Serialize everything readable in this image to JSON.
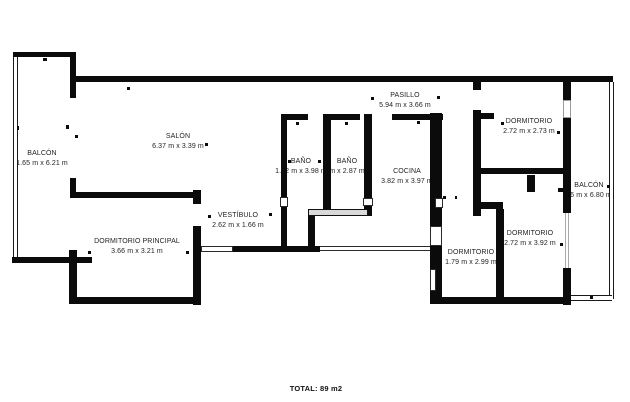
{
  "rooms": [
    {
      "name": "BALCÓN",
      "dims": "1.65 m x 6.21 m"
    },
    {
      "name": "SALÓN",
      "dims": "6.37 m x 3.39 m"
    },
    {
      "name": "PASILLO",
      "dims": "5.94 m x 3.66 m"
    },
    {
      "name": "BAÑO",
      "dims": "1.82 m x 3.98 m"
    },
    {
      "name": "BAÑO",
      "dims": "m x 2.87 m"
    },
    {
      "name": "COCINA",
      "dims": "3.82 m x 3.97 m"
    },
    {
      "name": "DORMITORIO",
      "dims": "2.72 m x 2.73 m"
    },
    {
      "name": "BALCÓN",
      "dims": "26 m x 6.80 m"
    },
    {
      "name": "VESTÍBULO",
      "dims": "2.62 m x 1.66 m"
    },
    {
      "name": "DORMITORIO PRINCIPAL",
      "dims": "3.66 m x 3.21 m"
    },
    {
      "name": "DORMITORIO",
      "dims": "1.79 m x 2.99 m"
    },
    {
      "name": "DORMITORIO",
      "dims": "2.72 m x 3.92 m"
    }
  ],
  "total": "TOTAL: 89 m2",
  "colors": {
    "wall": "#0b0b0b",
    "text": "#1f1f1f",
    "window_fill": "#d9d9d9",
    "background": "#ffffff"
  }
}
